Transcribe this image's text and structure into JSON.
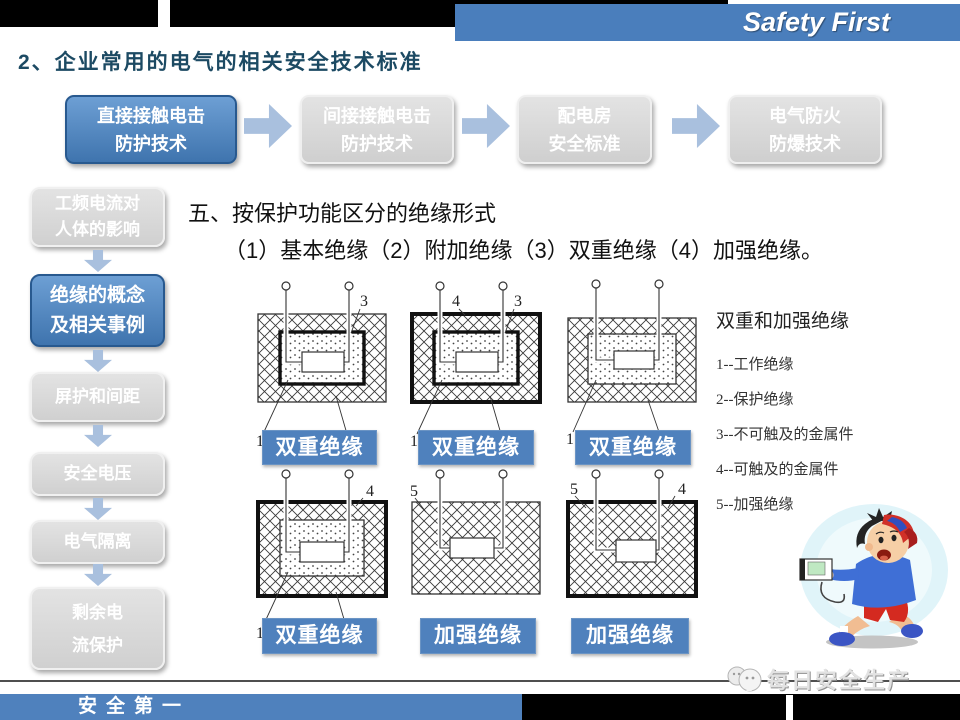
{
  "slide": {
    "brand": "Safety First",
    "title": "2、企业常用的电气的相关安全技术标准",
    "flow": {
      "items": [
        {
          "lines": [
            "直接接触电击",
            "防护技术"
          ]
        },
        {
          "lines": [
            "间接接触电击",
            "防护技术"
          ]
        },
        {
          "lines": [
            "配电房",
            "安全标准"
          ]
        },
        {
          "lines": [
            "电气防火",
            "防爆技术"
          ]
        }
      ]
    },
    "sidebar": {
      "items": [
        {
          "lines": [
            "工频电流对",
            "人体的影响"
          ]
        },
        {
          "lines": [
            "绝缘的概念",
            "及相关事例"
          ]
        },
        {
          "lines": [
            "屏护和间距"
          ]
        },
        {
          "lines": [
            "安全电压"
          ]
        },
        {
          "lines": [
            "电气隔离"
          ]
        },
        {
          "lines": [
            "剩余电",
            "流保护"
          ]
        }
      ]
    },
    "section": {
      "heading": "五、按保护功能区分的绝缘形式",
      "subheading": "（1）基本绝缘（2）附加绝缘（3）双重绝缘（4）加强绝缘。"
    },
    "diagrams": {
      "items": [
        {
          "label": "双重绝缘",
          "top_right": "3",
          "bottom_left": "1",
          "bottom_right": "2"
        },
        {
          "label": "双重绝缘",
          "top_left": "4",
          "top_right": "3",
          "bottom_left": "1",
          "bottom_right": "2"
        },
        {
          "label": "双重绝缘",
          "bottom_left": "1",
          "bottom_right": "2"
        },
        {
          "label": "双重绝缘",
          "top_right": "4",
          "bottom_left": "1",
          "bottom_right": "2"
        },
        {
          "label": "加强绝缘",
          "top_left": "5"
        },
        {
          "label": "加强绝缘",
          "top_left": "5",
          "top_right": "4"
        }
      ]
    },
    "legend": {
      "title": "双重和加强绝缘",
      "items": [
        "1--工作绝缘",
        "2--保护绝缘",
        "3--不可触及的金属件",
        "4--可触及的金属件",
        "5--加强绝缘"
      ]
    },
    "footer": {
      "slogan": "安全第一",
      "watermark": "每日安全生产"
    },
    "colors": {
      "accent": "#4f81bd",
      "accent_dark": "#28598f",
      "inactive_gray": "#d9d9d9",
      "arrow_blue": "#a9c0de",
      "title_blue": "#1c4a63"
    }
  }
}
